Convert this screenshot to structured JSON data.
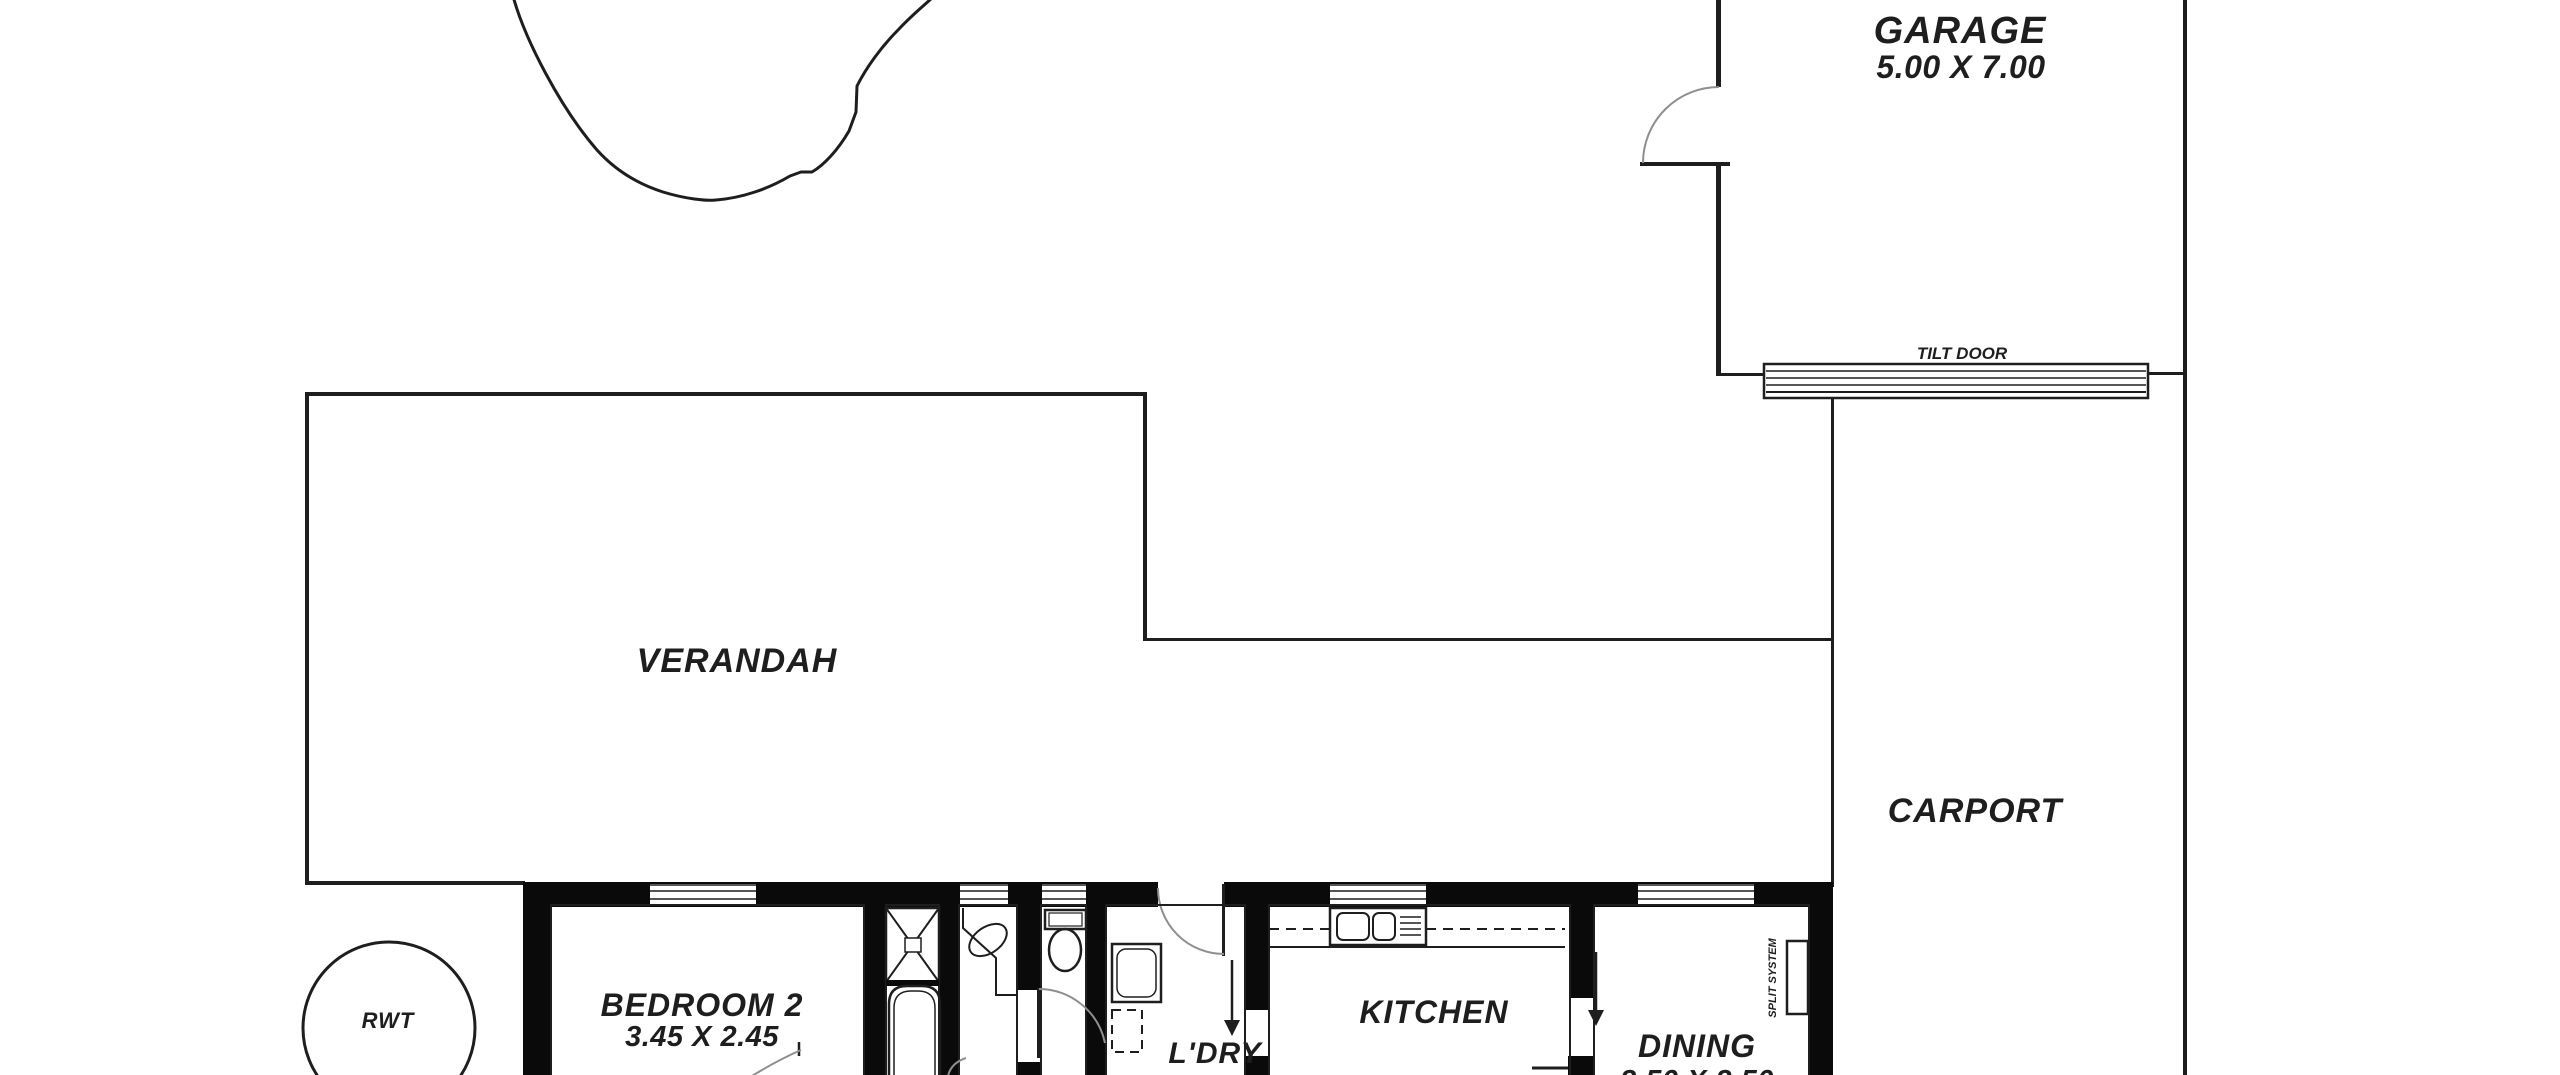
{
  "plan_type": "floor-plan",
  "colors": {
    "background": "#ffffff",
    "line": "#1e1e1e",
    "wall_fill": "#0a0a0a",
    "door_arc": "#8f8f8f"
  },
  "rooms": {
    "garage": {
      "label": "GARAGE",
      "dimensions": "5.00 X 7.00"
    },
    "verandah": {
      "label": "VERANDAH"
    },
    "carport": {
      "label": "CARPORT"
    },
    "bedroom2": {
      "label": "BEDROOM 2",
      "dimensions": "3.45 X 2.45"
    },
    "laundry": {
      "label": "L'DRY"
    },
    "kitchen": {
      "label": "KITCHEN"
    },
    "dining": {
      "label": "DINING",
      "dimensions": "3.50 X 3.50"
    }
  },
  "labels": {
    "tilt_door": "TILT DOOR",
    "rainwater_tank": "RWT",
    "split_system": "SPLIT SYSTEM"
  }
}
